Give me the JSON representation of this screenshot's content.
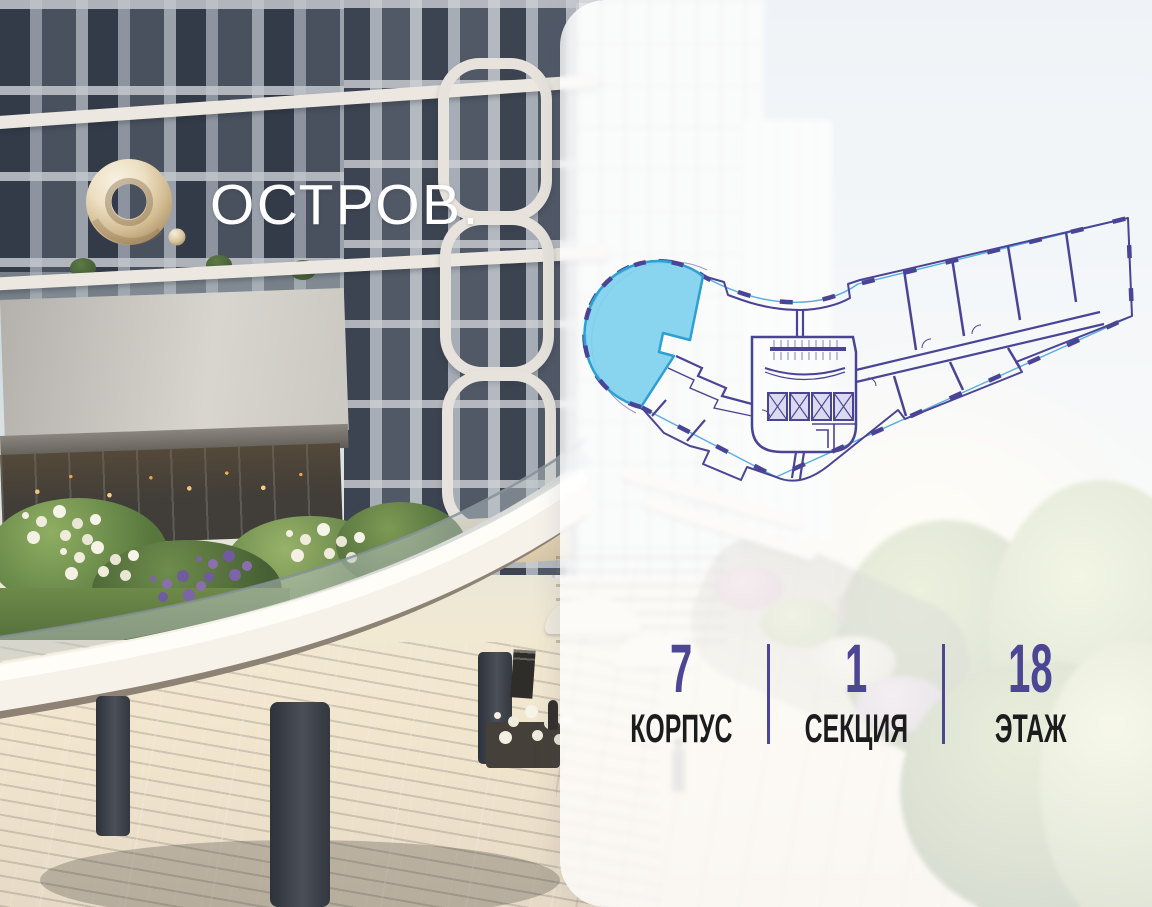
{
  "brand": {
    "wordmark": "ОСТРОВ.",
    "logo_icon": "gold-ring-o-icon",
    "logo_gold_color": "#d3bd94"
  },
  "panel": {
    "floorplan": {
      "line_color": "#4a4496",
      "glazing_color": "#58aede",
      "selected_unit": {
        "selected": true,
        "fill": "#7fd1ef",
        "outline": "#2d9fd2"
      }
    },
    "stats": [
      {
        "value": "7",
        "label": "КОРПУС"
      },
      {
        "value": "1",
        "label": "СЕКЦИЯ"
      },
      {
        "value": "18",
        "label": "ЭТАЖ"
      }
    ],
    "accent_color": "#4c4795",
    "label_color": "#1c1c1e"
  }
}
